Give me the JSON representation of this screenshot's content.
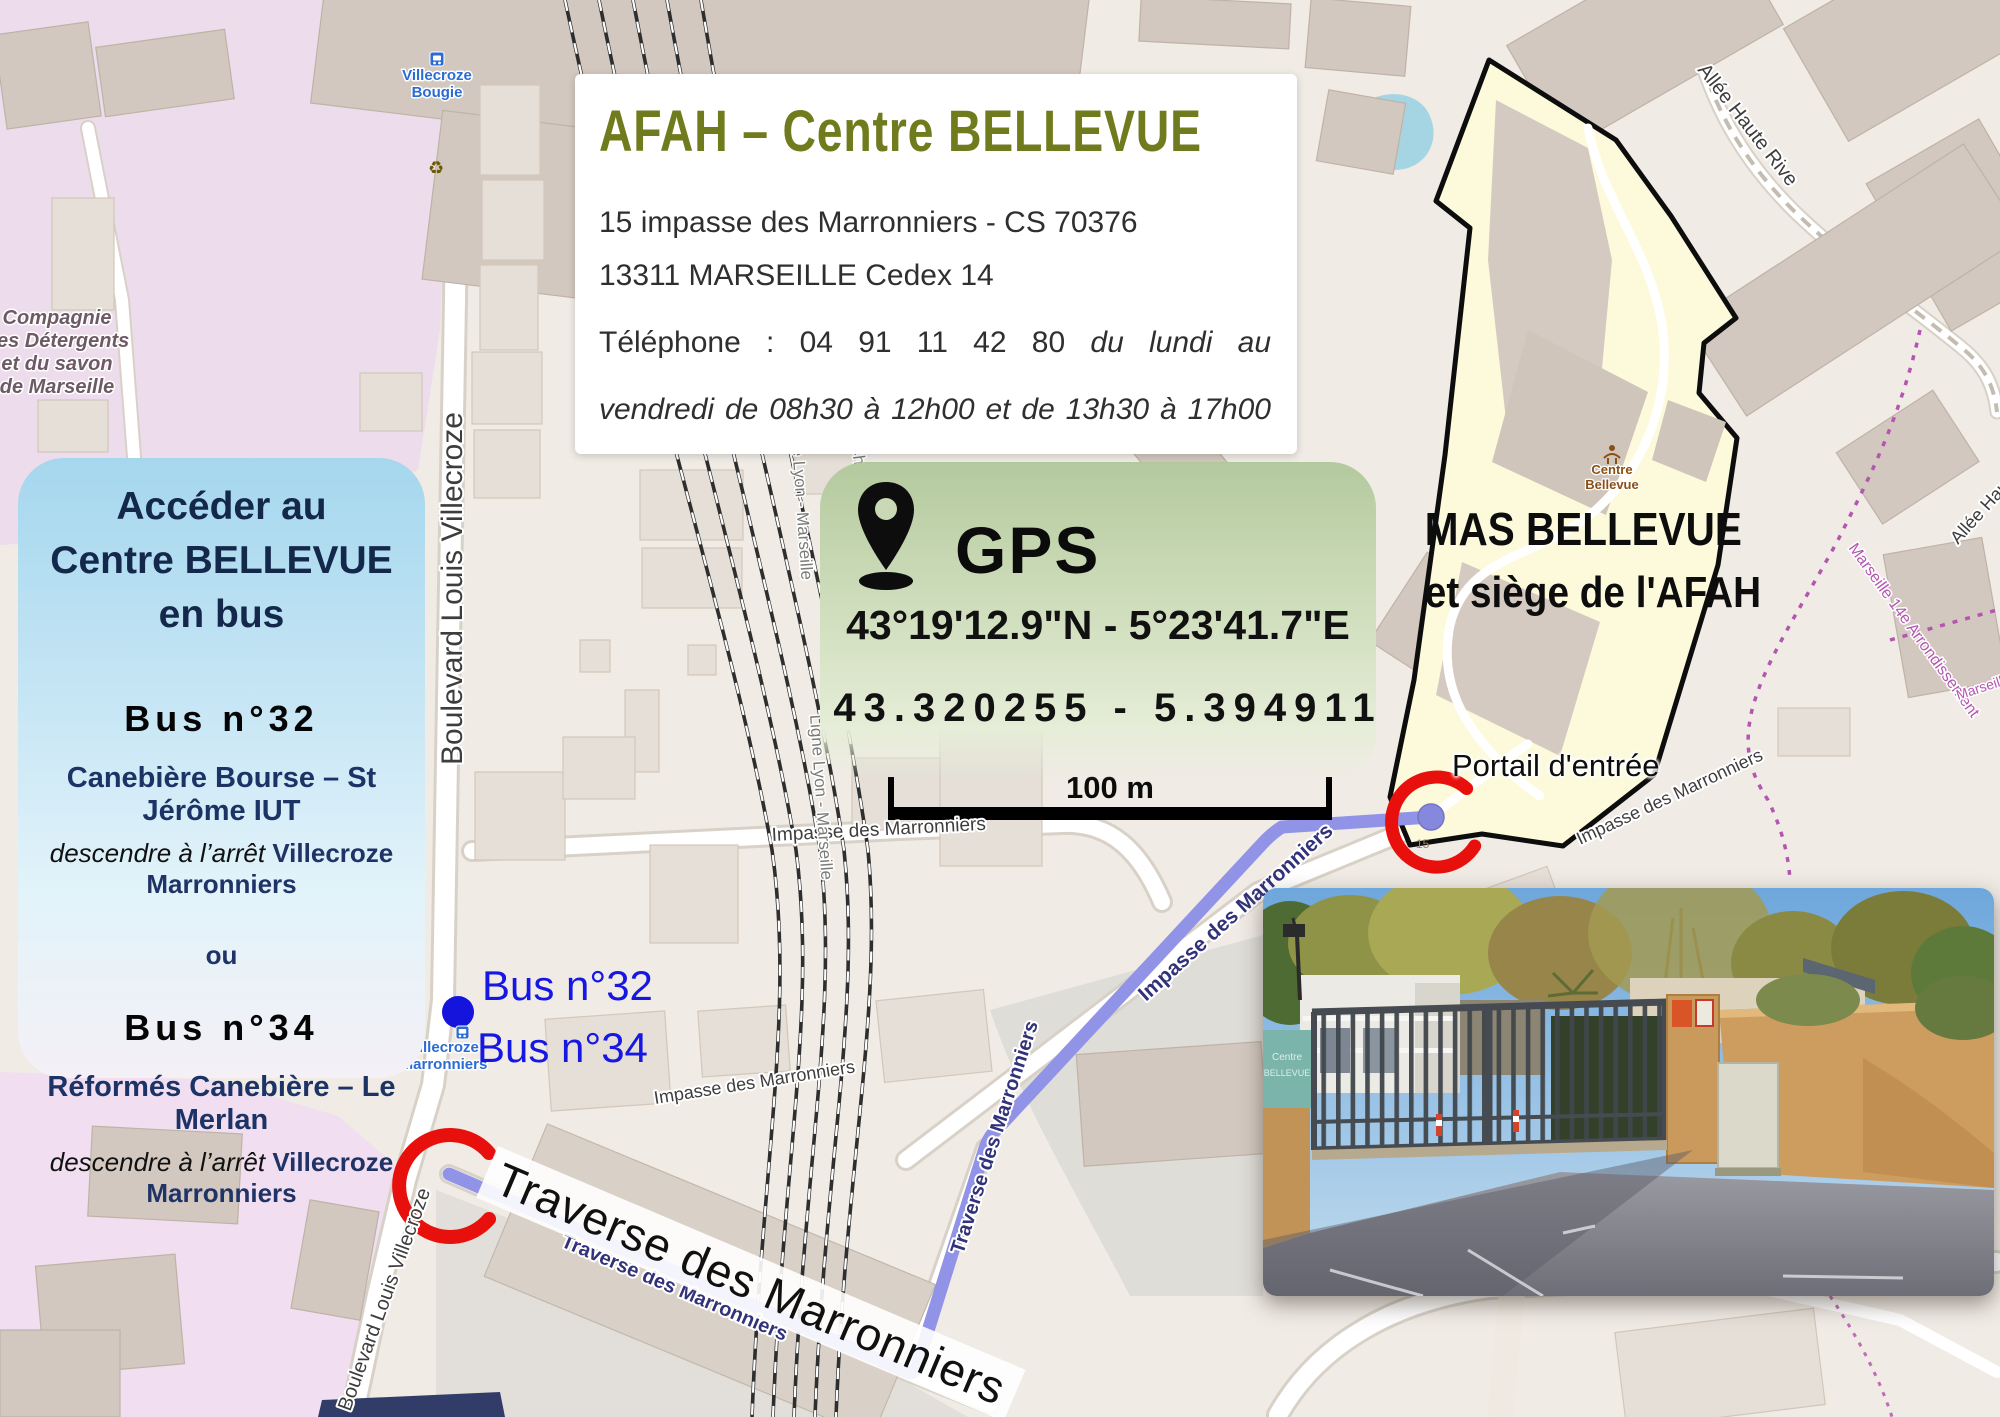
{
  "info_box": {
    "title": "AFAH – Centre BELLEVUE",
    "address_line1": "15 impasse des Marronniers - CS 70376",
    "address_line2": "13311 MARSEILLE Cedex 14",
    "phone_prefix": "Téléphone : 04 91 11 42 80",
    "phone_italic": "du lundi au",
    "phone_line2": "vendredi de 08h30 à 12h00 et de 13h30 à 17h00"
  },
  "gps_box": {
    "label": "GPS",
    "coords_dms": "43°19'12.9\"N - 5°23'41.7\"E",
    "coords_decimal": "43.320255 - 5.394911"
  },
  "scale_bar": {
    "label": "100 m"
  },
  "bus_box": {
    "title_line1": "Accéder au",
    "title_line2": "Centre BELLEVUE",
    "title_line3": "en bus",
    "bus32_name": "Bus n°32",
    "bus32_route": "Canebière Bourse – St Jérôme IUT",
    "stop_instruction_italic": "descendre à l’arrêt",
    "stop_instruction_stop": "Villecroze Marronniers",
    "separator": "ou",
    "bus34_name": "Bus n°34",
    "bus34_route": "Réformés Canebière – Le Merlan"
  },
  "annotations": {
    "bus32_label": "Bus n°32",
    "bus34_label": "Bus n°34",
    "portal_label": "Portail d'entrée",
    "mas_line1": "MAS BELLEVUE",
    "mas_line2": "et siège de l'AFAH",
    "traverse_big_label": "Traverse des Marronniers"
  },
  "map_labels": {
    "boulevard": "Boulevard Louis Villecroze",
    "impasse": "Impasse des Marronniers",
    "traverse": "Traverse des Marronniers",
    "railway_line": "Ligne Lyon - Marseille",
    "saint_charles": "Saint-Charles",
    "allee_haute_rive": "Allée Haute Rive",
    "arrondissement": "Marseille 14e Arrondissement",
    "marseille": "Marseille",
    "compagnie_line1": "Compagnie",
    "compagnie_line2": "des Détergents",
    "compagnie_line3": "et du savon",
    "compagnie_line4": "de Marseille",
    "stop_villecroze_line1": "Villecroze",
    "stop_villecroze_line2": "Bougie",
    "stop_marronniers_line1": "Villecroze",
    "stop_marronniers_line2": "Marronniers",
    "centre_bellevue_line1": "Centre",
    "centre_bellevue_line2": "Bellevue",
    "house_number": "15"
  },
  "photo": {
    "sign_line1": "Centre",
    "sign_line2": "BELLEVUE"
  },
  "colors": {
    "route": "#9193e6",
    "marker_red": "#e8100c",
    "bus_blue": "#1717e3",
    "title_olive": "#6f7b1c",
    "polygon_fill": "#fcfadb",
    "gps_green": "#c9d9b6",
    "bus_box_blue": "#a5d7ee"
  }
}
